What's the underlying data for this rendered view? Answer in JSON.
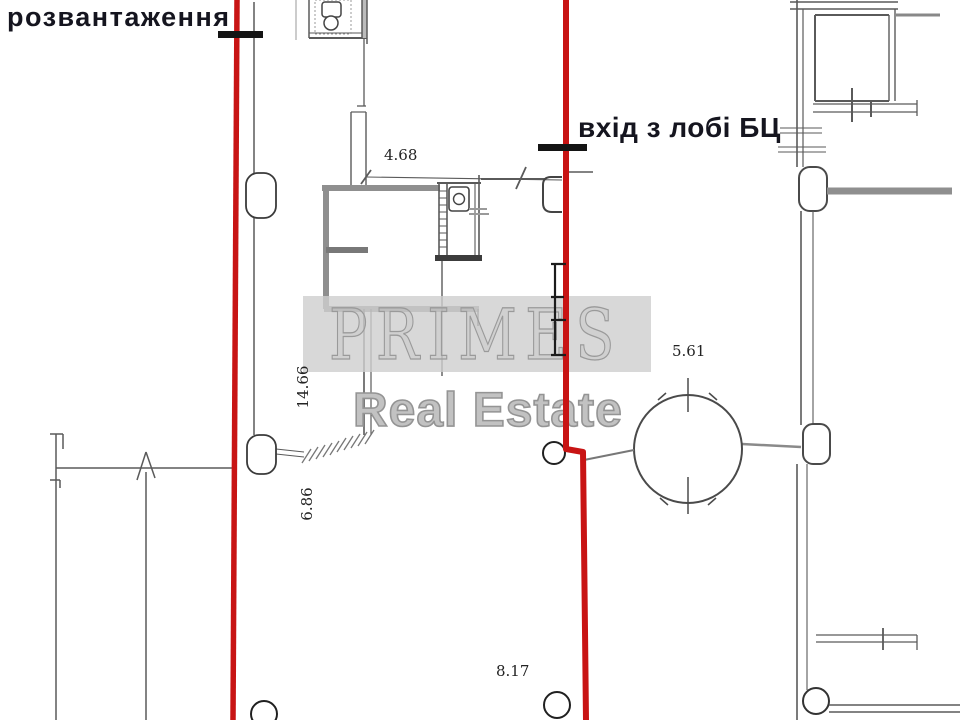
{
  "annotations": {
    "unloading": "розвантаження",
    "entrance": "вхід з лобі БЦ"
  },
  "dimensions": {
    "d1": "4.68",
    "d2": "5.61",
    "d3": "14.66",
    "d4": "6.86",
    "d5": "8.17"
  },
  "watermark": {
    "brand": "PRIMES",
    "tagline": "Real Estate"
  },
  "colors": {
    "boundary_red": "#c81414",
    "marker_black": "#141414",
    "wall_grey": "#5a5a5a",
    "thick_wall_grey": "#8f8f8f",
    "watermark_band": "#cecece",
    "watermark_text": "#9a9a9a"
  }
}
